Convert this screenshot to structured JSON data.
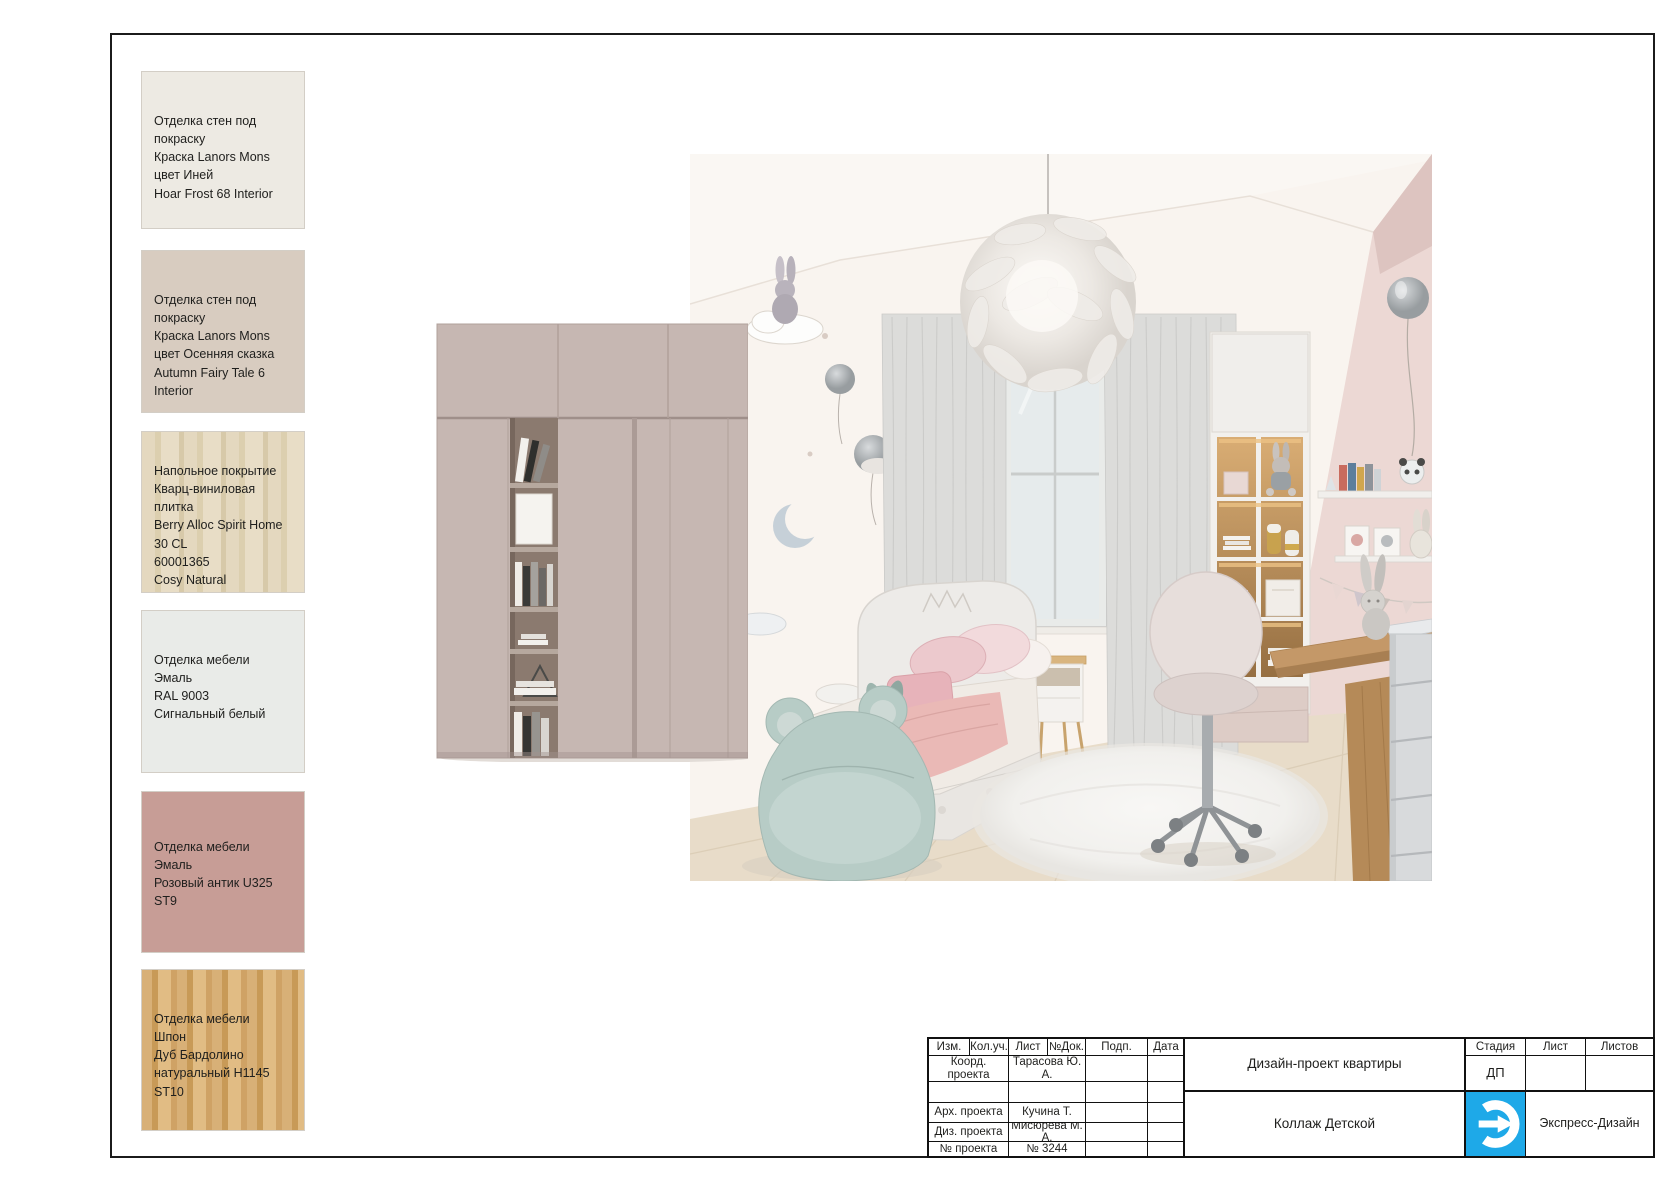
{
  "sheet": {
    "frame_color": "#1b1b1b",
    "background": "#ffffff"
  },
  "materials": [
    {
      "lines": [
        "Отделка стен под покраску",
        "Краска Lanors Mons",
        "цвет Иней",
        "Hoar Frost 68 Interior"
      ],
      "swatch_color": "#edeae3"
    },
    {
      "lines": [
        "Отделка стен под покраску",
        "Краска Lanors Mons",
        "цвет Осенняя сказка",
        "Autumn Fairy Tale 6 Interior"
      ],
      "swatch_color": "#d8ccc0"
    },
    {
      "lines": [
        "Напольное покрытие",
        "Кварц-виниловая плитка",
        "Berry Alloc Spirit Home",
        "30 CL",
        "60001365",
        "Cosy Natural"
      ],
      "swatch_color": "#ded2b8"
    },
    {
      "lines": [
        "Отделка мебели",
        "Эмаль",
        "RAL 9003",
        "Сигнальный белый"
      ],
      "swatch_color": "#e9ebe8"
    },
    {
      "lines": [
        "Отделка мебели",
        "Эмаль",
        "Розовый антик U325 ST9"
      ],
      "swatch_color": "#c79d96"
    },
    {
      "lines": [
        "Отделка мебели",
        "Шпон",
        "Дуб Бардолино",
        "натуральный H1145 ST10"
      ],
      "swatch_color": "#d0a76e"
    }
  ],
  "title_block": {
    "col_headers": [
      "Изм.",
      "Кол.уч.",
      "Лист",
      "№Док.",
      "Подп.",
      "Дата"
    ],
    "rows": [
      {
        "label": "Коорд. проекта",
        "value": "Тарасова Ю. А."
      },
      {
        "label": "",
        "value": ""
      },
      {
        "label": "Арх. проекта",
        "value": "Кучина Т."
      },
      {
        "label": "Диз. проекта",
        "value": "Мисюрева М. А."
      },
      {
        "label": "№ проекта",
        "value": "№ 3244"
      }
    ],
    "project_title": "Дизайн-проект квартиры",
    "sheet_title": "Коллаж Детской",
    "stage_header": "Стадия",
    "list_header": "Лист",
    "lists_header": "Листов",
    "stage_value": "ДП",
    "company_name": "Экспресс-Дизайн",
    "logo_color": "#1ea9e8"
  },
  "collage_colors": {
    "left_wall": "#f9f4ef",
    "right_wall": "#ecd8d4",
    "ceiling_corner": "#ddc4c0",
    "wardrobe": "#c6b7b2",
    "floor": "#e8dcc9",
    "curtains": "#dcdcda",
    "bean_bag": "#b7ccc6",
    "blanket": "#eab9b6",
    "desk_wood": "#c49868"
  }
}
